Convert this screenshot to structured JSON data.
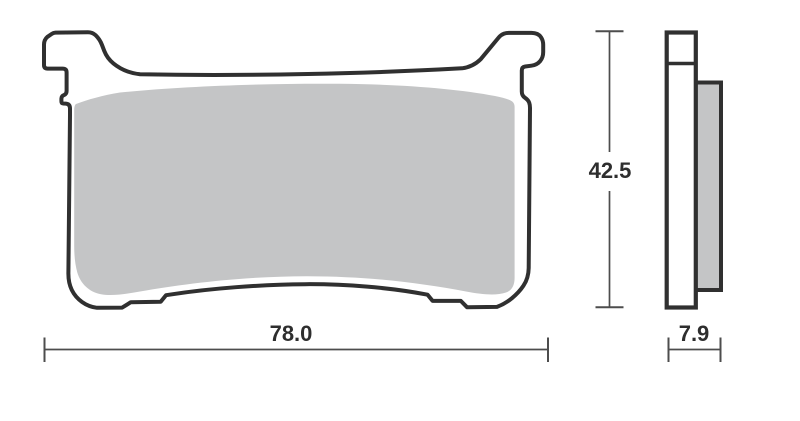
{
  "drawing": {
    "type": "brake-pad-technical-drawing",
    "dimensions": {
      "width": "78.0",
      "height": "42.5",
      "thickness": "7.9"
    },
    "colors": {
      "outline": "#303030",
      "friction": "#c4c5c6",
      "plate_fill": "#ffffff",
      "dim_line": "#4d4d4d",
      "label_text": "#2e2e2e",
      "background": "#ffffff"
    }
  }
}
